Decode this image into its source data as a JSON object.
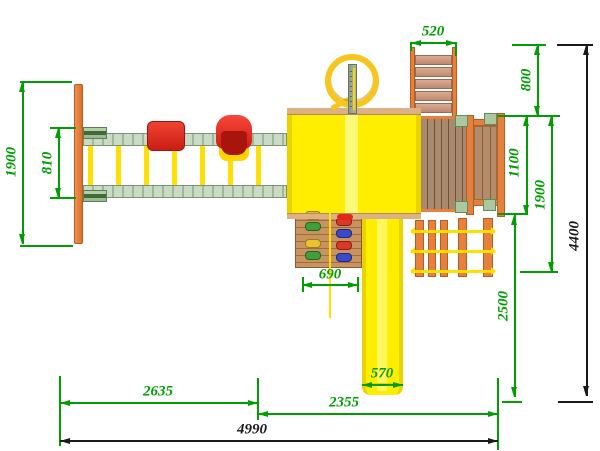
{
  "dims": {
    "swing_frame_depth": "1900",
    "swing_beam_spacing": "810",
    "ladder_width": "520",
    "ladder_offset": "800",
    "deck_depth": "1100",
    "platform_depth": "1900",
    "slide_run_depth": "2500",
    "total_depth": "4400",
    "climb_wall_width": "690",
    "slide_width": "570",
    "swing_section_length": "2635",
    "tower_section_length": "2355",
    "total_length": "4990"
  },
  "colors": {
    "dimension_green": "#009e00",
    "dimension_black": "#1a1a1a",
    "structure_yellow": "#ffee00",
    "ring_gold": "#f6c51e",
    "wood_orange": "#e5813c",
    "beam_green": "#b7ccb0",
    "seat_red": "#e02818",
    "deck_wood_brown": "#9c7e64"
  }
}
